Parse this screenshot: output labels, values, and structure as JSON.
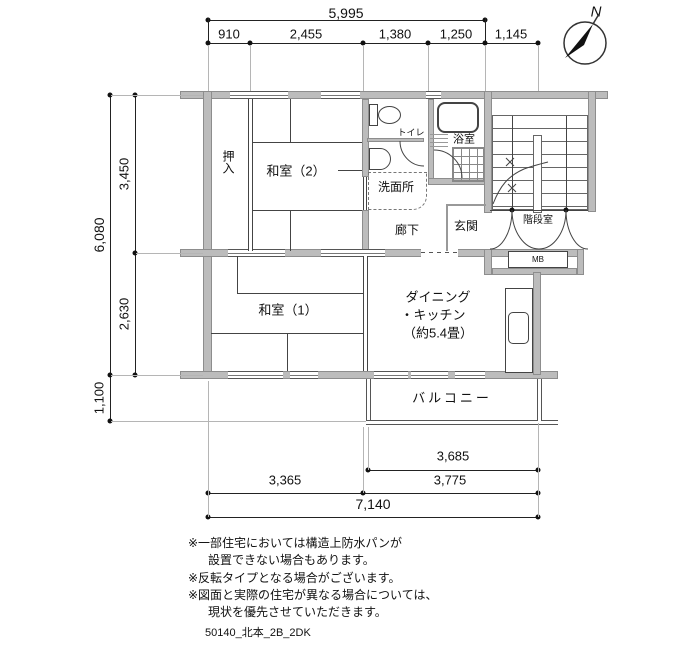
{
  "compass": {
    "north_label": "N"
  },
  "dims": {
    "top_total": "5,995",
    "top_segments": [
      "910",
      "2,455",
      "1,380",
      "1,250",
      "1,145"
    ],
    "left_total": "6,080",
    "left_upper": "3,450",
    "left_lower": "2,630",
    "left_balcony": "1,100",
    "bottom_inner": "3,685",
    "bottom_left": "3,365",
    "bottom_right": "3,775",
    "bottom_total": "7,140"
  },
  "rooms": {
    "oshiire": "押入",
    "washitsu2": "和室（2）",
    "toilet": "トイレ",
    "bath": "浴室",
    "washroom": "洗面所",
    "corridor": "廊下",
    "entrance": "玄関",
    "stairwell": "階段室",
    "meter_box": "MB",
    "washitsu1": "和室（1）",
    "dk_line1": "ダイニング",
    "dk_line2": "・キッチン",
    "dk_line3": "（約5.4畳）",
    "balcony": "バルコニー"
  },
  "notes": [
    "※一部住宅においては構造上防水パンが",
    "設置できない場合もあります。",
    "※反転タイプとなる場合がございます。",
    "※図面と実際の住宅が異なる場合については、",
    "現状を優先させていただきます。"
  ],
  "footer": "50140_北本_2B_2DK",
  "colors": {
    "wall": "#bcbcbc",
    "line": "#333333"
  }
}
